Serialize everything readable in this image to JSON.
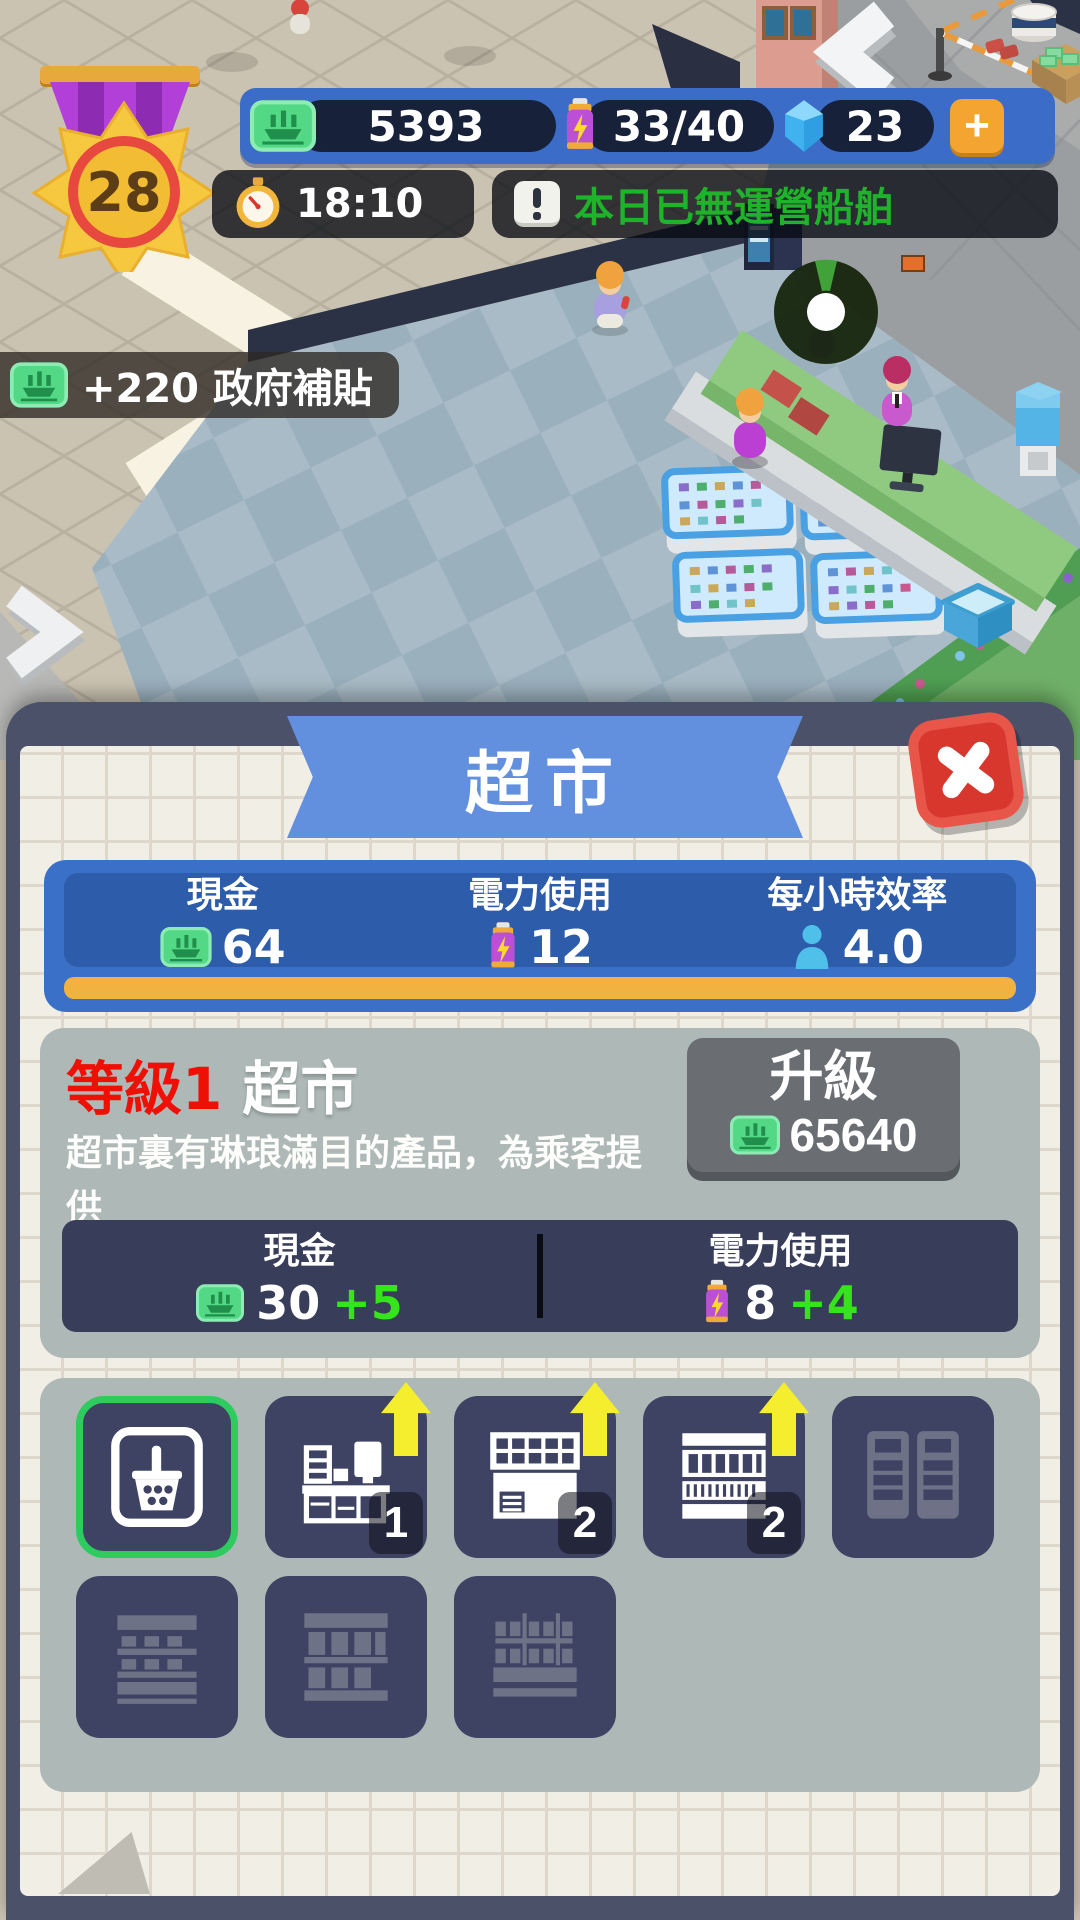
{
  "hud": {
    "level": "28",
    "money": "5393",
    "energy": "33/40",
    "gems": "23",
    "plus": "+",
    "time": "18:10",
    "alert": "本日已無運營船舶",
    "bonus": "+220 政府補貼"
  },
  "modal": {
    "title": "超市",
    "stats": {
      "cash_label": "現金",
      "cash_value": "64",
      "power_label": "電力使用",
      "power_value": "12",
      "eff_label": "每小時效率",
      "eff_value": "4.0"
    },
    "level": {
      "badge": "等級1",
      "name": "超市",
      "desc1": "超市裏有琳琅滿目的產品，為乘客提供",
      "desc2": "良好的購物體驗。",
      "upgrade_label": "升級",
      "upgrade_cost": "65640",
      "cash_label": "現金",
      "cash_value": "30",
      "cash_delta": "+5",
      "power_label": "電力使用",
      "power_value": "8",
      "power_delta": "+4"
    },
    "items": [
      {
        "id": "basket",
        "state": "selected"
      },
      {
        "id": "checkout-counter",
        "badge": "1",
        "upgradable": true
      },
      {
        "id": "display-shelf",
        "badge": "2",
        "upgradable": true
      },
      {
        "id": "stock-shelf",
        "badge": "2",
        "upgradable": true
      },
      {
        "id": "fridge-cabinets",
        "state": "locked"
      },
      {
        "id": "shelf-rows",
        "state": "locked"
      },
      {
        "id": "shelf-columns",
        "state": "locked"
      },
      {
        "id": "shelf-blocks",
        "state": "locked"
      }
    ]
  },
  "colors": {
    "hud_blue": "#3a6cc8",
    "pill_navy": "#18213a",
    "alert_green": "#1fb32b",
    "banner_blue": "#6290de",
    "close_red": "#d8372e",
    "panel_navy": "#4a5168",
    "paper": "#f1eee6",
    "stats_blue": "#2d5cab",
    "progress_yellow": "#f2b23f",
    "card_gray": "#aeb9b7",
    "level_red": "#ee1005",
    "delta_green": "#35e41a",
    "tile_navy": "#3e4263",
    "selected_green": "#2ecb5e",
    "upgrade_gray": "#6a6e73"
  },
  "icons": [
    "money-icon",
    "battery-icon",
    "gem-icon",
    "plus-icon",
    "clock-icon",
    "alert-icon",
    "person-icon",
    "basket-icon",
    "upgrade-arrow-icon",
    "close-icon"
  ]
}
